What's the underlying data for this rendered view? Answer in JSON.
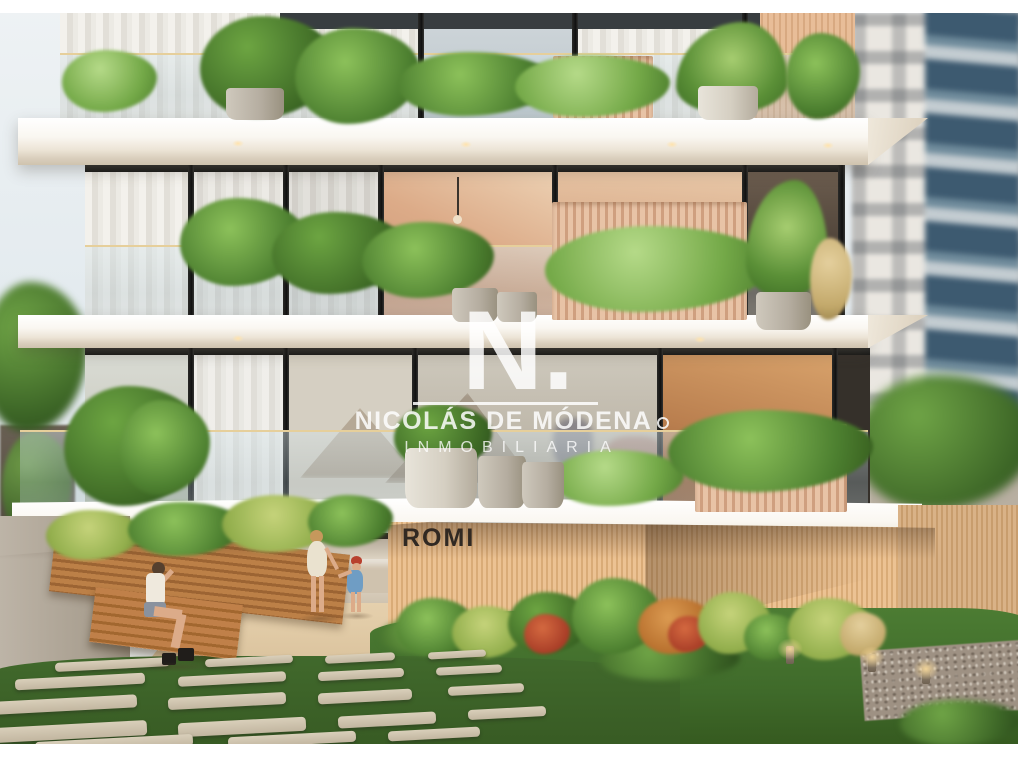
{
  "watermark": {
    "monogram": "N.",
    "name": "NICOLÁS DE MÓDENA",
    "subtitle": "INMOBILIARIA"
  },
  "building_sign": {
    "label": "ROMI"
  },
  "scene": {
    "type": "architectural-render-photo",
    "elements": [
      "apartment-building",
      "balcony-slabs",
      "glass-balustrades",
      "balcony-plants",
      "neighbor-towers",
      "entrance-lobby",
      "wood-slat-wall",
      "entrance-garden",
      "lawn",
      "stepping-stone-path",
      "walking-woman",
      "toddler",
      "seated-woman",
      "garden-lights"
    ]
  },
  "colors": {
    "frame": "#ffffff",
    "sky": "#e7edf0",
    "slab": "#f7f3ec",
    "glass_mullion": "#1e1e1c",
    "curtain": "#efece6",
    "sunset_reflection": "#d9a184",
    "wood_slat": "#ddae80",
    "romi_wall": "#e4ba8b",
    "sign_text": "#2e2925",
    "foliage": "#4f7f33",
    "lawn": "#44722f",
    "neighbor_blue": "#41607a",
    "path_stone": "#d3c7b2",
    "walkway": "#e6d3b4",
    "watermark": "#ffffff"
  }
}
